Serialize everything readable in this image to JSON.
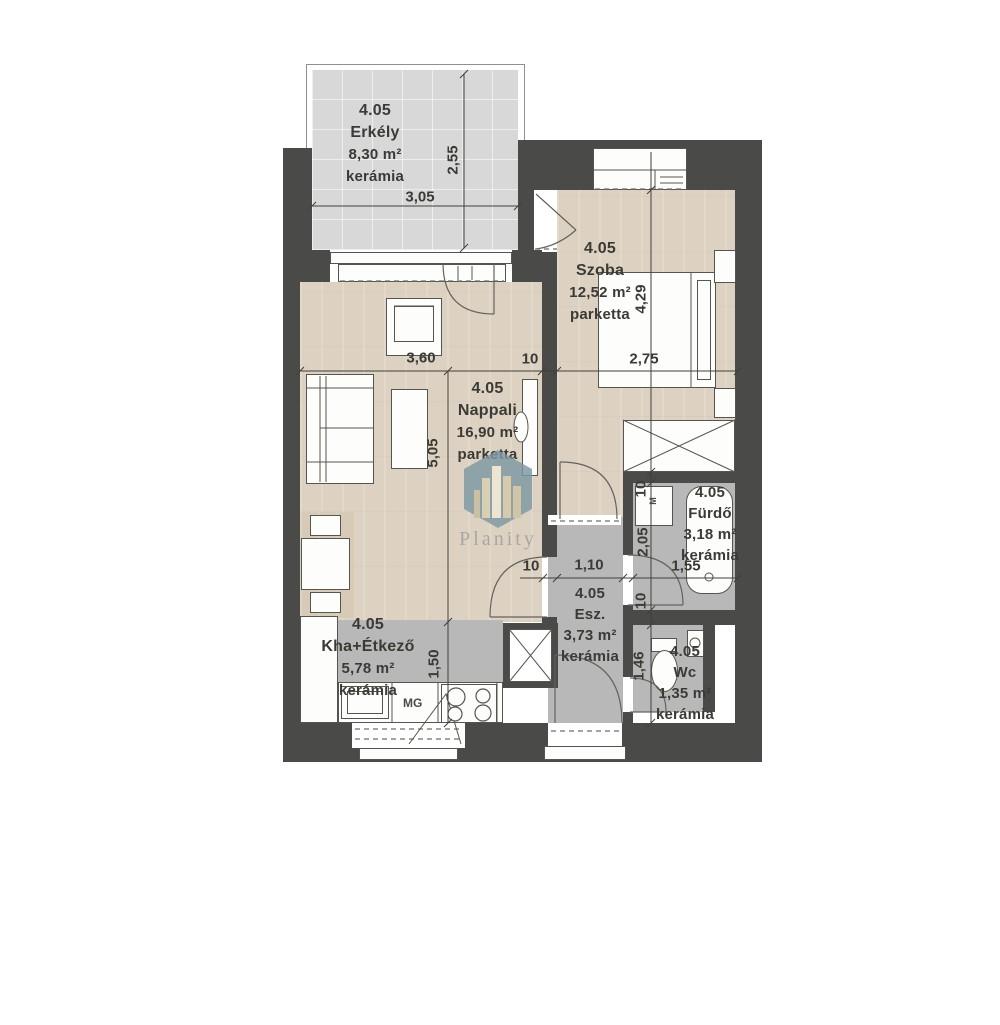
{
  "brand": {
    "name": "Planity"
  },
  "rooms": [
    {
      "key": "erkely",
      "number": "4.05",
      "name": "Erkély",
      "area": "8,30 m²",
      "floor": "kerámia"
    },
    {
      "key": "szoba",
      "number": "4.05",
      "name": "Szoba",
      "area": "12,52 m²",
      "floor": "parketta"
    },
    {
      "key": "nappali",
      "number": "4.05",
      "name": "Nappali",
      "area": "16,90 m²",
      "floor": "parketta"
    },
    {
      "key": "furdo",
      "number": "4.05",
      "name": "Fürdő",
      "area": "3,18 m²",
      "floor": "kerámia"
    },
    {
      "key": "esz",
      "number": "4.05",
      "name": "Esz.",
      "area": "3,73 m²",
      "floor": "kerámia"
    },
    {
      "key": "kha",
      "number": "4.05",
      "name": "Kha+Étkező",
      "area": "5,78 m²",
      "floor": "kerámia"
    },
    {
      "key": "wc",
      "number": "4.05",
      "name": "Wc",
      "area": "1,35 m²",
      "floor": "kerámia"
    }
  ],
  "dimensions": {
    "erkely_width": "3,05",
    "erkely_depth": "2,55",
    "nappali_width": "3,60",
    "wall_top": "10",
    "szoba_width": "2,75",
    "szoba_depth": "4,29",
    "nappali_depth": "5,05",
    "kha_depth": "1,50",
    "esz_wall": "10",
    "esz_width": "1,10",
    "furdo_wall_top": "10",
    "furdo_depth": "2,05",
    "furdo_width": "1,55",
    "furdo_wall_bottom": "10",
    "wc_depth": "1,46"
  },
  "appliances": {
    "dishwasher": "MG",
    "washing_machine": "M"
  },
  "colors": {
    "wall": "#4a4a48",
    "wood_floor": "#ddd2c1",
    "ceramic_floor": "#b8b8b8",
    "balcony_tile": "#d8d8d8",
    "watermark_hex": "#7d99a3",
    "label_text": "#3a3a36"
  }
}
